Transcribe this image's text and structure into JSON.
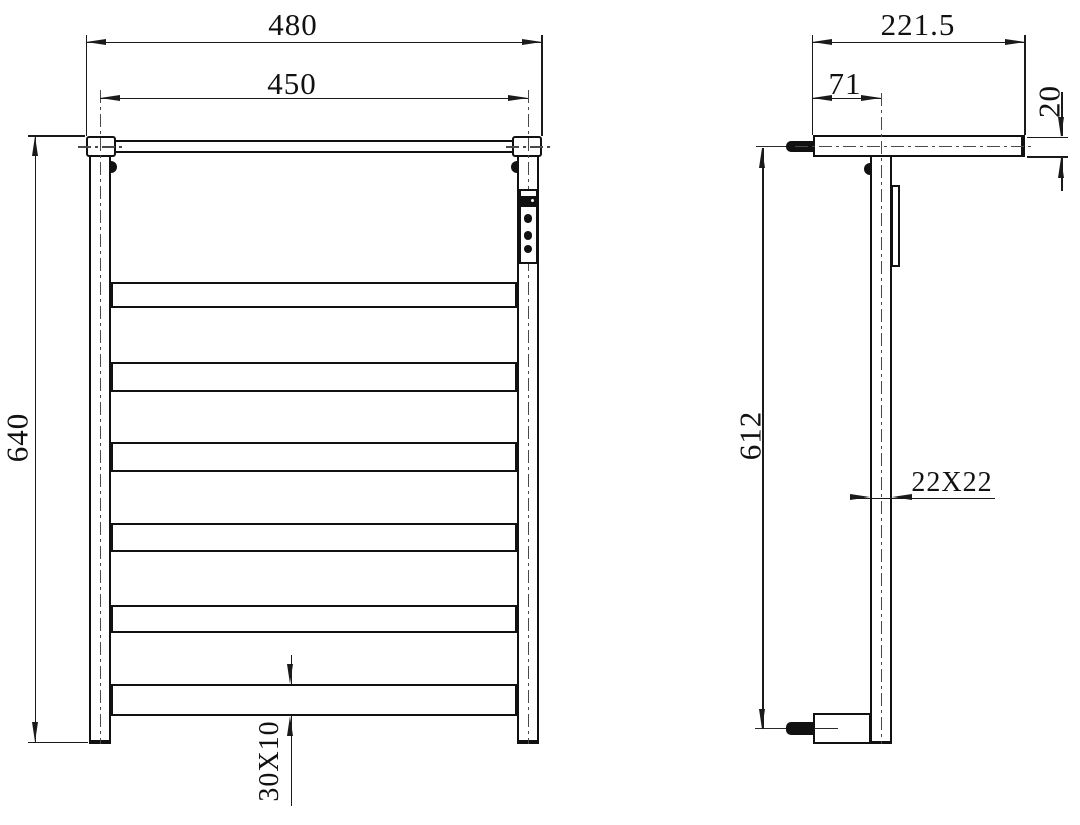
{
  "front_view": {
    "dims": {
      "overall_width": "480",
      "rail_center_width": "450",
      "overall_height": "640",
      "bar_profile": "30X10"
    },
    "rung_count": 6,
    "control_buttons": 3
  },
  "side_view": {
    "dims": {
      "overall_depth": "221.5",
      "wall_to_post": "71",
      "shelf_thickness": "20",
      "mount_height": "612",
      "post_profile": "22X22"
    }
  },
  "colors": {
    "line": "#1a1a1a",
    "centerline": "#4a4a4a",
    "background": "#ffffff"
  }
}
